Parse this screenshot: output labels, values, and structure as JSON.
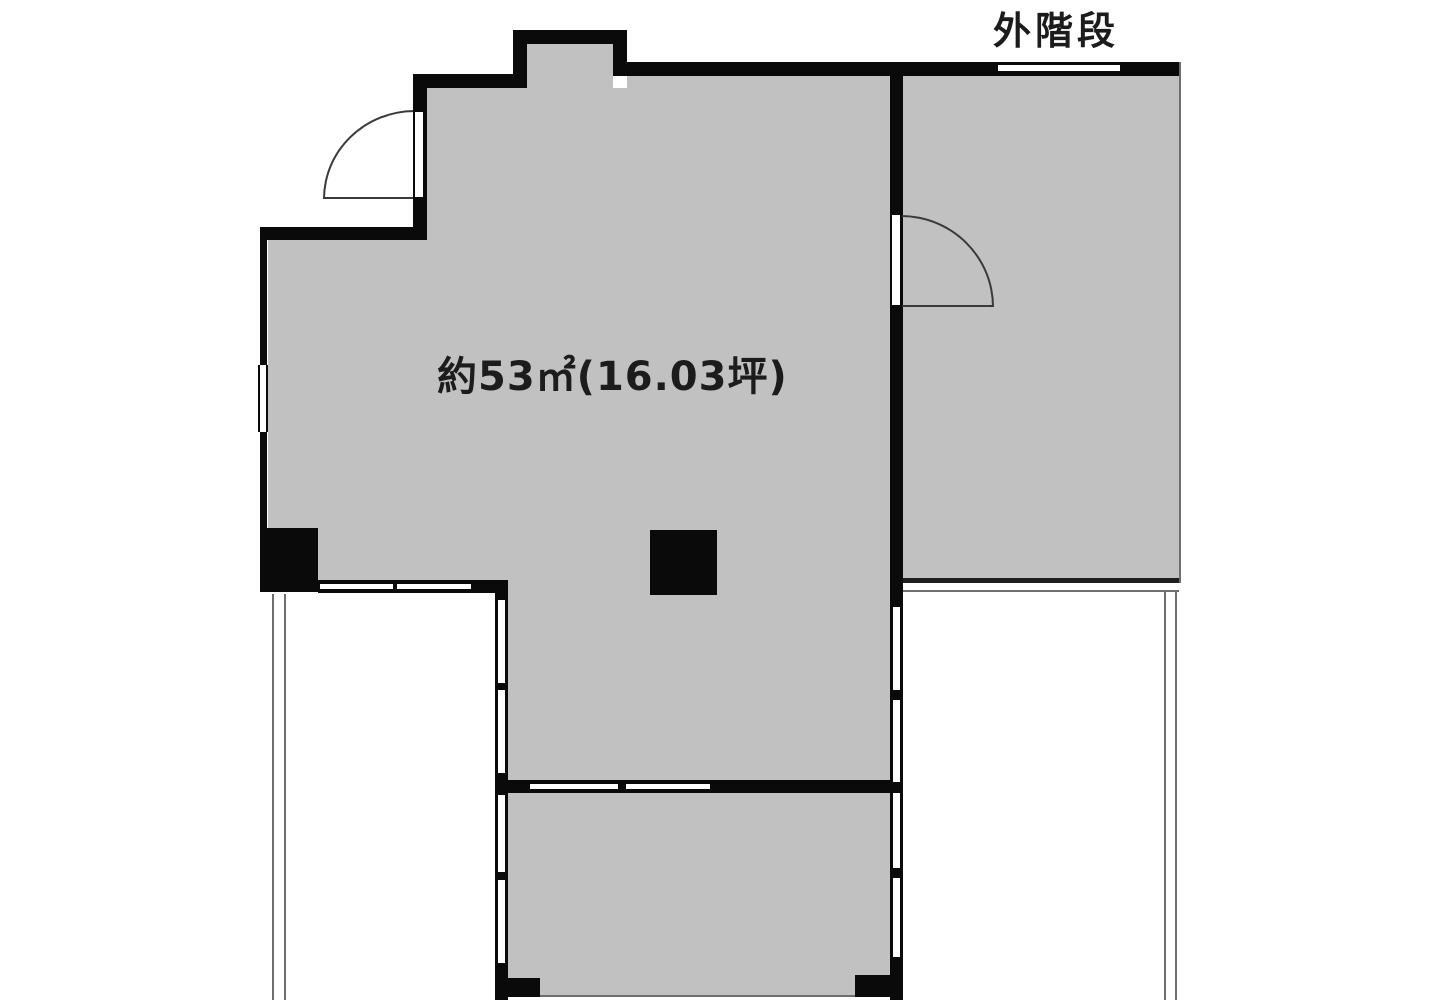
{
  "labels": {
    "outside_stairs": "外階段",
    "floor_area": "約53㎡(16.03坪)"
  },
  "colors": {
    "floor-fill": "#c1c1c1",
    "wall": "#0a0a0a",
    "outline": "#6e6e6e",
    "text": "#1c1c1c",
    "background": "#ffffff"
  }
}
